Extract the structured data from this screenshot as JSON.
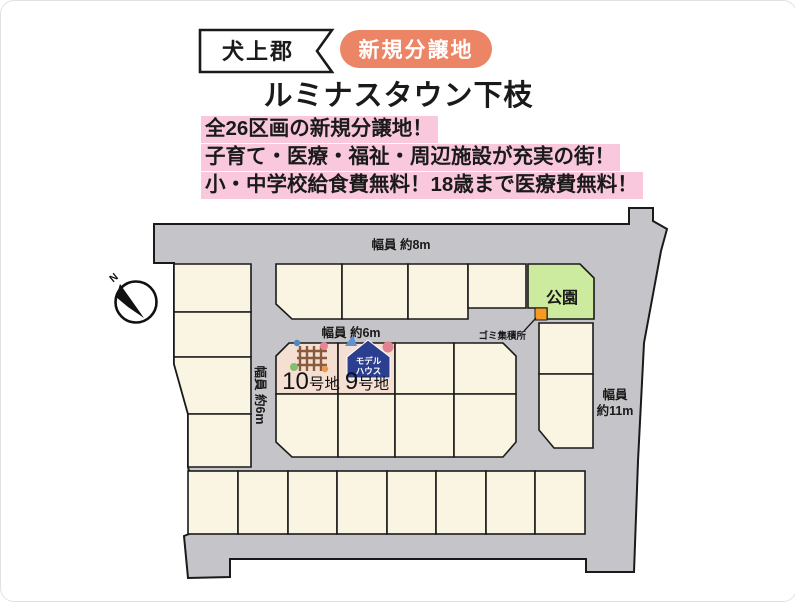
{
  "header": {
    "area_label": "犬上郡",
    "badge_label": "新規分譲地",
    "title": "ルミナスタウン下枝",
    "highlight_lines": [
      "全26区画の新規分譲地！",
      "子育て・医療・福祉・周辺施設が充実の街！",
      "小・中学校給食費無料！18歳まで医療費無料！"
    ]
  },
  "map": {
    "compass_label": "N",
    "road_label_top": "幅員 約8m",
    "road_label_middle": "幅員 約6m",
    "road_label_left": "幅員 約6m",
    "road_label_right_l1": "幅員",
    "road_label_right_l2": "約11m",
    "park_label": "公園",
    "garbage_label": "ゴミ集積所",
    "model_house_l1": "モデル",
    "model_house_l2": "ハウス",
    "lot10_number": "10",
    "lot10_suffix": "号地",
    "lot9_number": "9",
    "lot9_suffix": "号地",
    "total_lots": "26"
  },
  "colors": {
    "road": "#c5c4c8",
    "lot": "#faf4e3",
    "featured_lot": "#f4dfd2",
    "park": "#cdeb9f",
    "garbage_marker": "#f59a23",
    "badge": "#ec8566",
    "highlight": "#f9c8dc",
    "model_house_badge": "#2c3e8f"
  }
}
